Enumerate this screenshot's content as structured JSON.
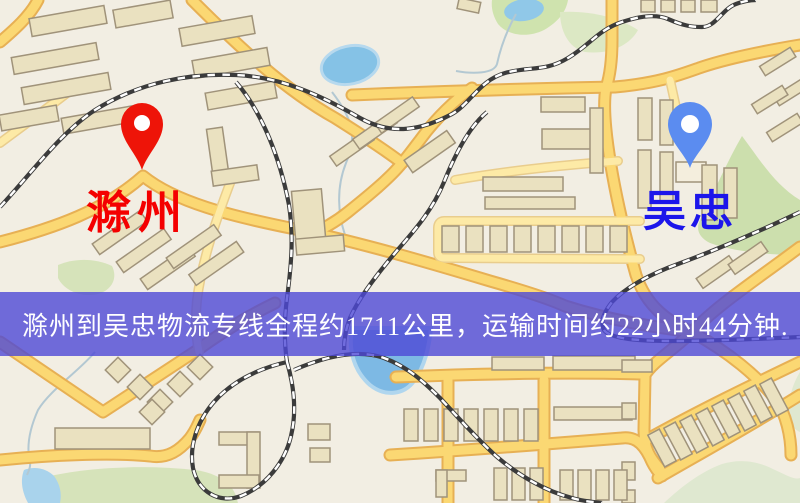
{
  "window": {
    "width": 800,
    "height": 503
  },
  "map": {
    "markers": [
      {
        "id": "origin",
        "label": "滁州",
        "pin_color": "#ee1408",
        "label_color": "#f40000"
      },
      {
        "id": "destination",
        "label": "吴忠",
        "pin_color": "#5b8cf0",
        "label_color": "#1c16ea"
      }
    ]
  },
  "banner": {
    "text": "滁州到吴忠物流专线全程约1711公里，运输时间约22小时44分钟.",
    "background": "rgba(78,72,214,0.8)",
    "text_color": "#ffffff"
  },
  "map_colors": {
    "land": "#f2eee3",
    "road_fill": "#fbd873",
    "road_casing": "#e7b054",
    "minor_road": "#fdeaa6",
    "park": "#ccdfad",
    "park_pale": "#dfe8d0",
    "water": "#85c2e6",
    "building_fill": "#eae1c0",
    "building_stroke": "#a0937a",
    "railway": "#3b3b3b"
  }
}
